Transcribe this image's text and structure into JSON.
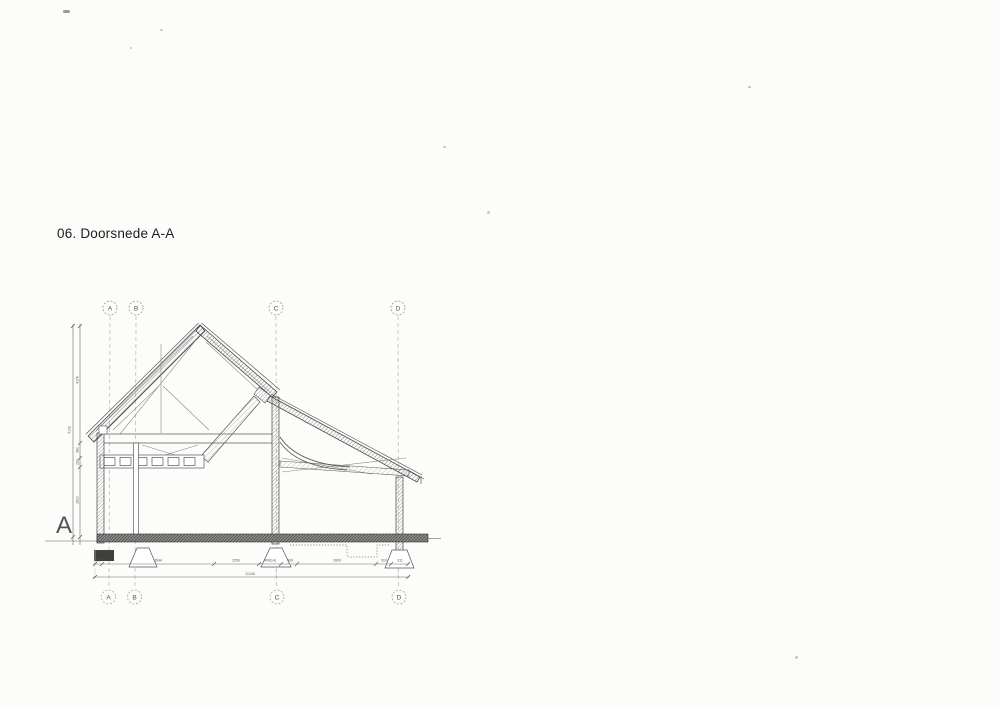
{
  "page": {
    "title": "06. Doorsnede A-A"
  },
  "drawing": {
    "type": "architectural-section",
    "section_marker": "A",
    "grid": {
      "labels": [
        "A",
        "B",
        "C",
        "D"
      ]
    },
    "dimensions": {
      "horizontal_segments": [
        "235",
        "3544",
        "2250",
        "409(14)",
        "909",
        "2600",
        "910",
        "311"
      ],
      "horizontal_total": "11248",
      "vertical_segments": [
        "4176",
        "580",
        "290",
        "2600"
      ],
      "vertical_total": "7106"
    }
  }
}
